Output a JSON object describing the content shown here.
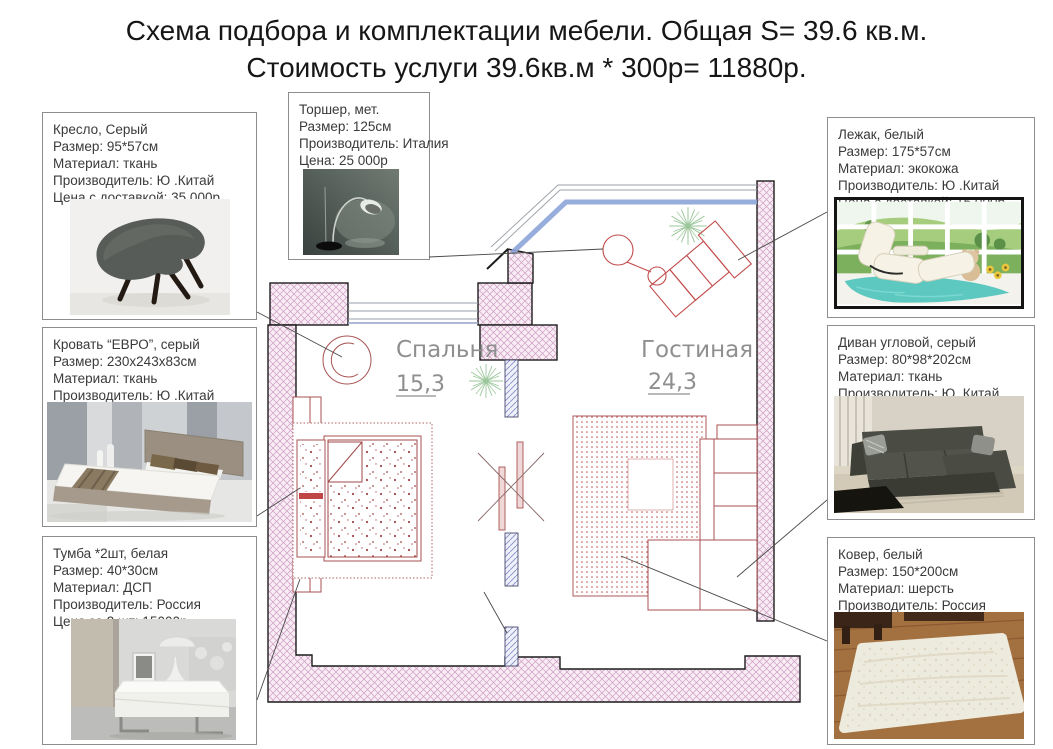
{
  "title": {
    "line1": "Схема подбора и комплектации мебели. Общая S= 39.6 кв.м.",
    "line2": "Стоимость услуги 39.6кв.м * 300р= 11880р."
  },
  "callouts": {
    "armchair": {
      "name": "Кресло, Серый",
      "size": "Размер: 95*57см",
      "material": "Материал: ткань",
      "manufacturer": "Производитель: Ю .Китай",
      "price": "Цена с доставкой: 35 000р"
    },
    "torchere": {
      "name": "Торшер, мет.",
      "size": "Размер: 125см",
      "manufacturer": "Производитель: Италия",
      "price": "Цена: 25 000р"
    },
    "bed": {
      "name": "Кровать “ЕВРО”, серый",
      "size": "Размер: 230х243х83см",
      "material": "Материал: ткань",
      "manufacturer": "Производитель: Ю .Китай",
      "price": "Цена с доставкой: 55 000р"
    },
    "nightstand": {
      "name": "Тумба *2шт, белая",
      "size": "Размер: 40*30см",
      "material": "Материал: ДСП",
      "manufacturer": "Производитель: Россия",
      "price": "Цена за 2 шт: 15000р"
    },
    "lounger": {
      "name": "Лежак, белый",
      "size": "Размер: 175*57см",
      "material": "Материал: экокожа",
      "manufacturer": "Производитель: Ю .Китай",
      "price": "Цена с доставкой: 15 000р"
    },
    "sofa": {
      "name": "Диван угловой, серый",
      "size": "Размер: 80*98*202см",
      "material": "Материал: ткань",
      "manufacturer": "Производитель: Ю .Китай",
      "price": "Цена с доставкой: 80 000р"
    },
    "carpet": {
      "name": "Ковер, белый",
      "size": "Размер: 150*200см",
      "material": "Материал: шерсть",
      "manufacturer": "Производитель: Россия",
      "price": "Цена с доставкой: 35000р"
    }
  },
  "plan": {
    "bedroom": {
      "label": "Спальня",
      "area": "15,3"
    },
    "living": {
      "label": "Гостиная",
      "area": "24,3"
    }
  },
  "colors": {
    "wall_hatch": "#cf9ec2",
    "partition_hatch": "#8890c8",
    "furniture_outline": "#a85252",
    "window_blue": "#8ca4d8",
    "room_label": "#8f8f8f"
  }
}
